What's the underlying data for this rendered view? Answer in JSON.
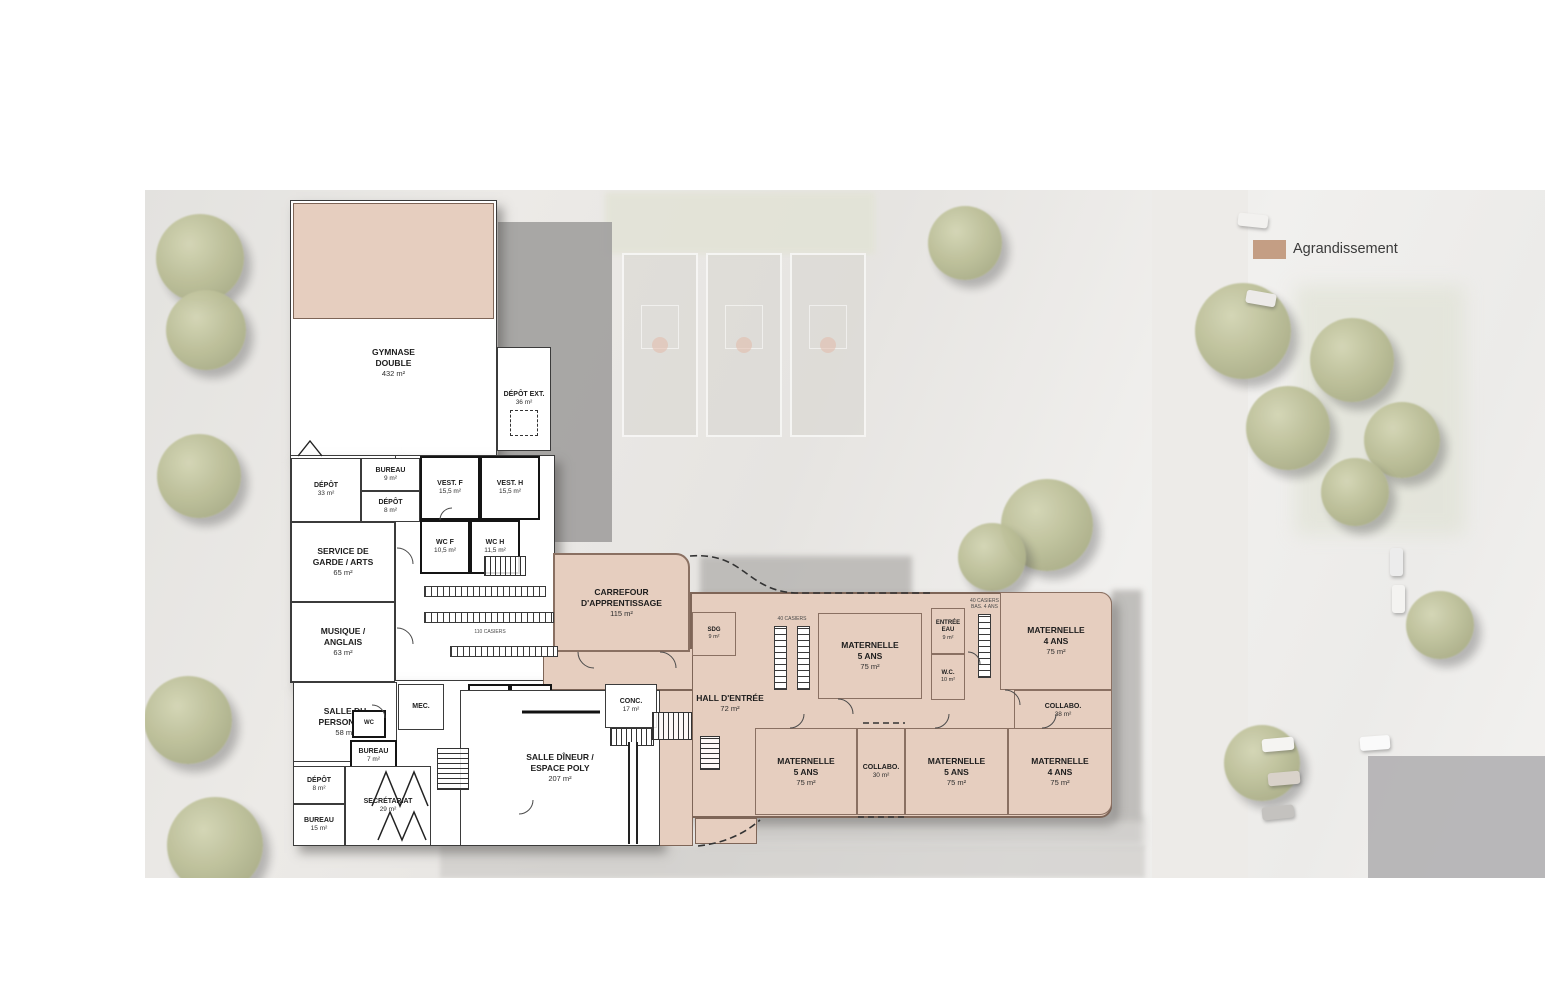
{
  "legend": {
    "label": "Agrandissement",
    "swatch_color": "#c49e84"
  },
  "colors": {
    "agrandissement_fill": "#e6cebf",
    "wall_existing": "#3b3b3b",
    "wall_agrandissement": "#7e6557",
    "photo_base": "#eae9e6"
  },
  "rooms": [
    {
      "label": "GYMNASE\nDOUBLE",
      "area": "432 m²",
      "type": "existing"
    },
    {
      "label": "DÉPÔT EXT.",
      "area": "36 m²",
      "type": "existing"
    },
    {
      "label": "DÉPÔT",
      "area": "33 m²",
      "type": "existing"
    },
    {
      "label": "BUREAU",
      "area": "9 m²",
      "type": "existing"
    },
    {
      "label": "DÉPÔT",
      "area": "8 m²",
      "type": "existing"
    },
    {
      "label": "VEST. F",
      "area": "15,5 m²",
      "type": "existing"
    },
    {
      "label": "VEST. H",
      "area": "15,5 m²",
      "type": "existing"
    },
    {
      "label": "SERVICE DE\nGARDE / ARTS",
      "area": "65 m²",
      "type": "existing"
    },
    {
      "label": "WC F",
      "area": "10,5 m²",
      "type": "existing"
    },
    {
      "label": "WC H",
      "area": "11,5 m²",
      "type": "existing"
    },
    {
      "label": "MUSIQUE /\nANGLAIS",
      "area": "63 m²",
      "type": "existing"
    },
    {
      "label": "SALLE DU\nPERSONNEL",
      "area": "58 m²",
      "type": "existing"
    },
    {
      "label": "WC",
      "area": "",
      "type": "existing"
    },
    {
      "label": "MEC.",
      "area": "",
      "type": "existing"
    },
    {
      "label": "WC F",
      "area": "12 m²",
      "type": "existing"
    },
    {
      "label": "WC H",
      "area": "12 m²",
      "type": "existing"
    },
    {
      "label": "BUREAU",
      "area": "7 m²",
      "type": "existing"
    },
    {
      "label": "DÉPÔT",
      "area": "8 m²",
      "type": "existing"
    },
    {
      "label": "SECRÉTARIAT",
      "area": "29 m²",
      "type": "existing"
    },
    {
      "label": "BUREAU",
      "area": "15 m²",
      "type": "existing"
    },
    {
      "label": "CUISINE",
      "area": "37 m²",
      "type": "existing"
    },
    {
      "label": "SALLE DÎNEUR /\nESPACE POLY",
      "area": "207 m²",
      "type": "existing"
    },
    {
      "label": "CONC.",
      "area": "17 m²",
      "type": "existing"
    },
    {
      "label": "CARREFOUR\nD'APPRENTISSAGE",
      "area": "115 m²",
      "type": "new"
    },
    {
      "label": "SDG",
      "area": "9 m²",
      "type": "new"
    },
    {
      "label": "HALL D'ENTRÉE",
      "area": "72 m²",
      "type": "new"
    },
    {
      "label": "MATERNELLE\n5 ANS",
      "area": "75 m²",
      "type": "new"
    },
    {
      "label": "ENTRÉE\nEAU",
      "area": "9 m²",
      "type": "new"
    },
    {
      "label": "W.C.",
      "area": "10 m²",
      "type": "new"
    },
    {
      "label": "MATERNELLE\n4 ANS",
      "area": "75 m²",
      "type": "new"
    },
    {
      "label": "COLLABO.",
      "area": "38 m²",
      "type": "new"
    },
    {
      "label": "MATERNELLE\n5 ANS",
      "area": "75 m²",
      "type": "new"
    },
    {
      "label": "COLLABO.",
      "area": "30 m²",
      "type": "new"
    },
    {
      "label": "MATERNELLE\n5 ANS",
      "area": "75 m²",
      "type": "new"
    },
    {
      "label": "MATERNELLE\n4 ANS",
      "area": "75 m²",
      "type": "new"
    }
  ],
  "small_labels": {
    "casiers_corridor": "110 CASIERS",
    "casiers_hall": "40 CASIERS",
    "casiers_wing": "40 CASIERS\nBAS. 4 ANS"
  }
}
